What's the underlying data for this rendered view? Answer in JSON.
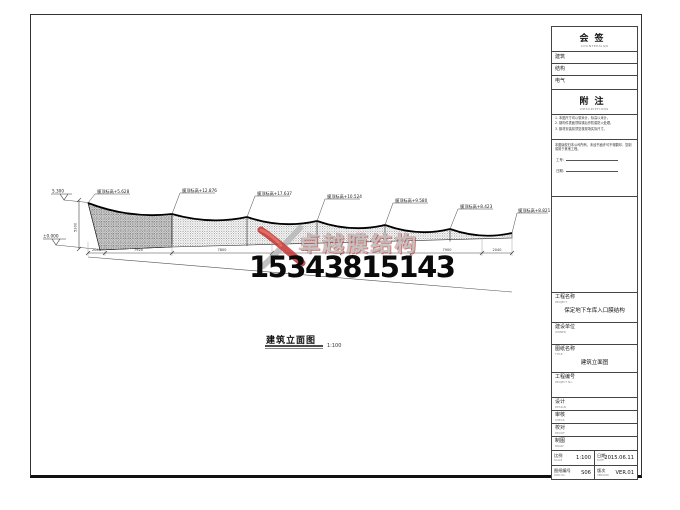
{
  "watermark": {
    "brand": "卓越膜结构",
    "phone": "15343815143"
  },
  "drawing": {
    "title": "建筑立面图",
    "title_scale": "1:100",
    "level_top": "5.300",
    "level_bottom": "±0.000",
    "vertical_dim": "5300",
    "peak_labels": [
      "膜顶标高+5.628",
      "膜顶标高+12.876",
      "膜顶标高+17.637",
      "膜顶标高+10.524",
      "膜顶标高+9.580",
      "膜顶标高+8.423",
      "膜顶标高+8.821"
    ],
    "bottom_dims": [
      "2040",
      "7920",
      "7800",
      "7900",
      "7900",
      "7900",
      "2040"
    ]
  },
  "titleblock": {
    "countersign": {
      "label": "会签",
      "sub": "COUNTERSIGN"
    },
    "countersign_rows": [
      {
        "label": "建筑"
      },
      {
        "label": "结构"
      },
      {
        "label": "电气"
      }
    ],
    "notes": {
      "label": "附注",
      "sub": "DESCRIPTIONS",
      "items": [
        "1. 本图尺寸均以毫米计，标高以米计。",
        "2. 钢构件表面须除锈后作防腐防火处理。",
        "3. 膜材安装前须复核现场实际尺寸。"
      ],
      "statement": "本图版权归本公司所有，未经书面许可不得翻印、复制或用于其他工程。",
      "job_no_label": "工号：",
      "date_label": "日期："
    },
    "project": {
      "label": "工程名称",
      "sub": "PROJECT",
      "value": "保定地下车库入口膜结构"
    },
    "owner": {
      "label": "建设单位",
      "sub": "OWNER"
    },
    "drawing_name": {
      "label": "图纸名称",
      "sub": "TITLE",
      "value": "建筑立面图"
    },
    "project_no": {
      "label": "工程编号",
      "sub": "PROJECT No."
    },
    "sign_rows": [
      {
        "label": "设计",
        "sub": "DESIGN"
      },
      {
        "label": "审核",
        "sub": "CHECK"
      },
      {
        "label": "校对",
        "sub": "PROOF"
      },
      {
        "label": "制图",
        "sub": "DRAW"
      }
    ],
    "scale": {
      "label": "比例",
      "sub": "SCALE",
      "value": "1:100"
    },
    "date": {
      "label": "日期",
      "sub": "DATE",
      "value": "2015.06.11"
    },
    "dwg_no": {
      "label": "图纸编号",
      "sub": "DWG No.",
      "value": "S06"
    },
    "version": {
      "label": "版次",
      "sub": "VERSION",
      "value": "VER.01"
    }
  }
}
